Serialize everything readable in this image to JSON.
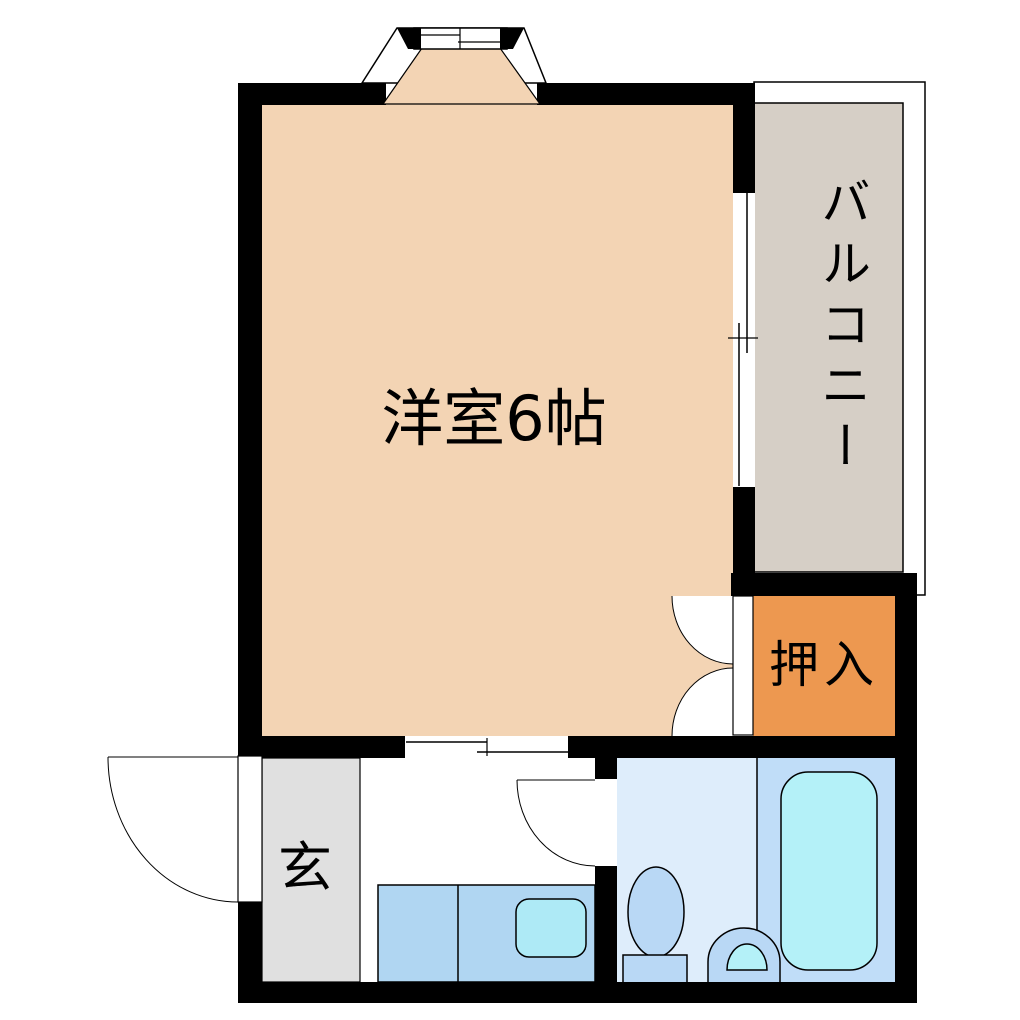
{
  "rooms": {
    "main_room": {
      "label": "洋室6帖"
    },
    "balcony": {
      "label": "バルコニー"
    },
    "closet": {
      "label": "押入"
    },
    "entrance": {
      "label": "玄"
    }
  },
  "colors": {
    "wall": "#000000",
    "line": "#000000",
    "main_room_floor": "#f3d4b4",
    "balcony_floor": "#d6cfc6",
    "closet_floor": "#ed9850",
    "entrance_floor": "#e0e0e0",
    "kitchen_counter": "#b0d6f2",
    "kitchen_sink": "#aeeaf6",
    "toilet_room_floor": "#deedfb",
    "bath_room_floor": "#c0ddf8",
    "bathtub": "#b4f1f8",
    "fixture_fill": "#b9d8f5",
    "door_fill": "#ffffff"
  }
}
